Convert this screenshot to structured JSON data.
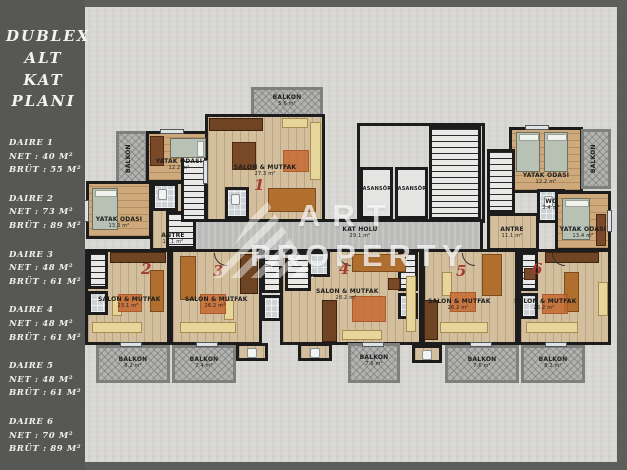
{
  "sidebar": {
    "title_lines": [
      "DUBLEX",
      "ALT KAT",
      "PLANI"
    ],
    "units": [
      {
        "name": "DAIRE 1",
        "net": "NET : 40 M²",
        "brut": "BRÜT : 55 M²"
      },
      {
        "name": "DAIRE 2",
        "net": "NET : 73 M²",
        "brut": "BRÜT : 89 M²"
      },
      {
        "name": "DAIRE 3",
        "net": "NET : 48 M²",
        "brut": "BRÜT : 61 M²"
      },
      {
        "name": "DAIRE 4",
        "net": "NET : 48 M²",
        "brut": "BRÜT : 61 M²"
      },
      {
        "name": "DAIRE 5",
        "net": "NET : 48 M²",
        "brut": "BRÜT : 61 M²"
      },
      {
        "name": "DAIRE 6",
        "net": "NET : 70 M²",
        "brut": "BRÜT : 89 M²"
      }
    ]
  },
  "plan": {
    "labels": {
      "balkon": "BALKON",
      "yatak": "YATAK ODASI",
      "salon": "SALON & MUTFAK",
      "antre": "ANTRE",
      "wc": "WC",
      "asansor": "ASANSÖR",
      "kat_holu": "KAT HOLÜ"
    },
    "areas": {
      "kat_holu": "29.1 m²",
      "bal_left": "9.1 m²",
      "bal_top": "5.6 m²",
      "bal_right": "8.2 m²",
      "bal_b2": "8.2 m²",
      "bal_b3": "7.4 m²",
      "bal_b4": "7.6 m²",
      "bal_b5": "7.6 m²",
      "bal_b6": "8.2 m²",
      "salon1": "27.3 m²",
      "salon2": "23.1 m²",
      "salon3": "26.2 m²",
      "salon4": "28.2 m²",
      "salon5": "26.2 m²",
      "salon6": "25.2 m²",
      "bed_tl_a": "12.2 m²",
      "bed_tl_b": "13.3 m²",
      "bed_tr_a": "12.2 m²",
      "bed_tr_b": "13.4 m²",
      "antre_l": "11.1 m²",
      "antre_r": "11.1 m²",
      "wc": "3.4 m²"
    },
    "numbers": [
      "1",
      "2",
      "3",
      "4",
      "5",
      "6"
    ]
  },
  "watermark": {
    "line1": "ART",
    "line2": "PROPERTY"
  },
  "colors": {
    "accent_red": "#a53a31",
    "wall": "#1c1c1c",
    "wood_floor": "#d3bf9e",
    "balcony_gray": "#b2b2b0",
    "sidebar_bg": "#575755",
    "concrete": "#d8d7d4"
  }
}
